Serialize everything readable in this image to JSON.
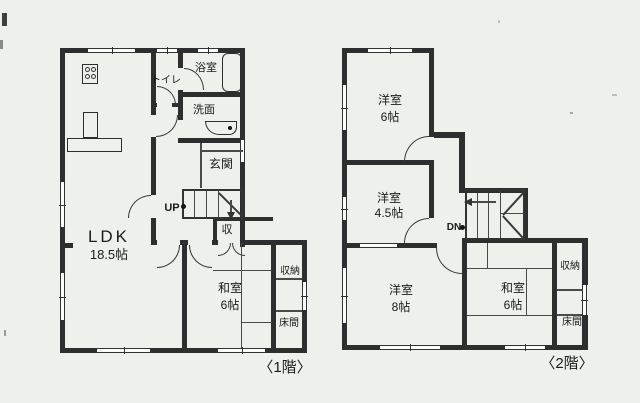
{
  "document": {
    "type": "floor-plan-scan",
    "colors": {
      "paper": "#eef0ec",
      "ink": "#2e2e2e"
    }
  },
  "floor1": {
    "caption": "〈1階〉",
    "rooms": {
      "ldk": {
        "name": "LDK",
        "size": "18.5帖"
      },
      "washitsu": {
        "name": "和室",
        "size": "6帖"
      },
      "bath": {
        "name": "浴室"
      },
      "toilet": {
        "name": "トイレ"
      },
      "washroom": {
        "name": "洗面"
      },
      "entrance": {
        "name": "玄関"
      },
      "storage": {
        "name": "収"
      },
      "closet": {
        "name": "収納"
      },
      "tokonoma": {
        "name": "床間"
      }
    },
    "stairs": {
      "label": "UP"
    }
  },
  "floor2": {
    "caption": "〈2階〉",
    "rooms": {
      "western1": {
        "name": "洋室",
        "size": "6帖"
      },
      "western2": {
        "name": "洋室",
        "size": "4.5帖"
      },
      "western3": {
        "name": "洋室",
        "size": "8帖"
      },
      "washitsu": {
        "name": "和室",
        "size": "6帖"
      },
      "closet": {
        "name": "収納"
      },
      "tokonoma": {
        "name": "床間"
      }
    },
    "stairs": {
      "label": "DN"
    }
  }
}
